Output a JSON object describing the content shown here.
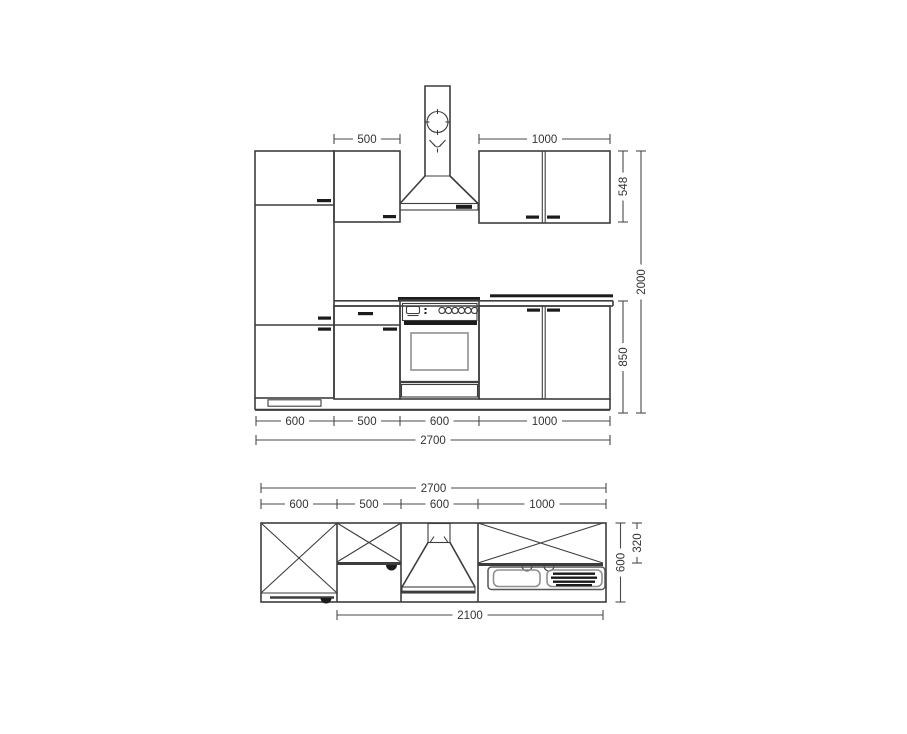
{
  "title": "kitchen-unit-technical-drawing",
  "colors": {
    "background": "#ffffff",
    "line": "#3d3d3d",
    "dimension_line": "#4a4a4a",
    "dark_fill": "#1c1c1c",
    "gray_detail": "#8f8f8f",
    "text": "#333333"
  },
  "elevation": {
    "dim_wall_cab_left_width": "500",
    "dim_wall_cab_right_width": "1000",
    "dim_wall_cab_height": "548",
    "dim_total_height": "2000",
    "dim_base_height": "850",
    "dim_unit_widths": [
      "600",
      "500",
      "600",
      "1000"
    ],
    "dim_total_width": "2700"
  },
  "plan": {
    "dim_total_width": "2700",
    "dim_unit_widths": [
      "600",
      "500",
      "600",
      "1000"
    ],
    "dim_wall_cab_depth": "320",
    "dim_worktop_depth": "600",
    "dim_run_width": "2100"
  }
}
